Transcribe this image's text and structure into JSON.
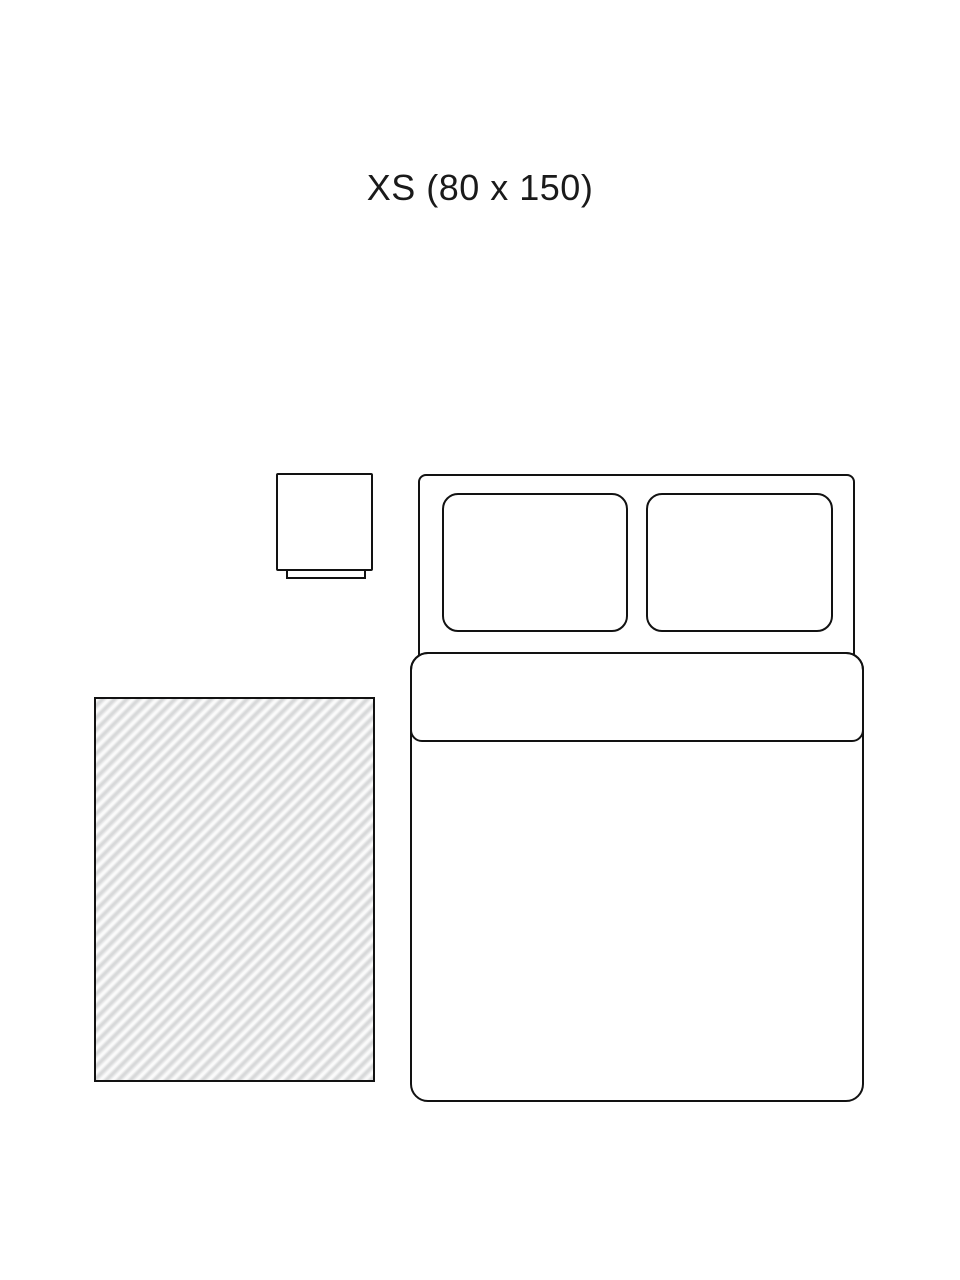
{
  "title": "XS (80 x 150)",
  "colors": {
    "background": "#ffffff",
    "line": "#121212",
    "text": "#1a1a1a",
    "rug_stripe": "#d8d9da",
    "rug_gap": "#fafafa"
  }
}
